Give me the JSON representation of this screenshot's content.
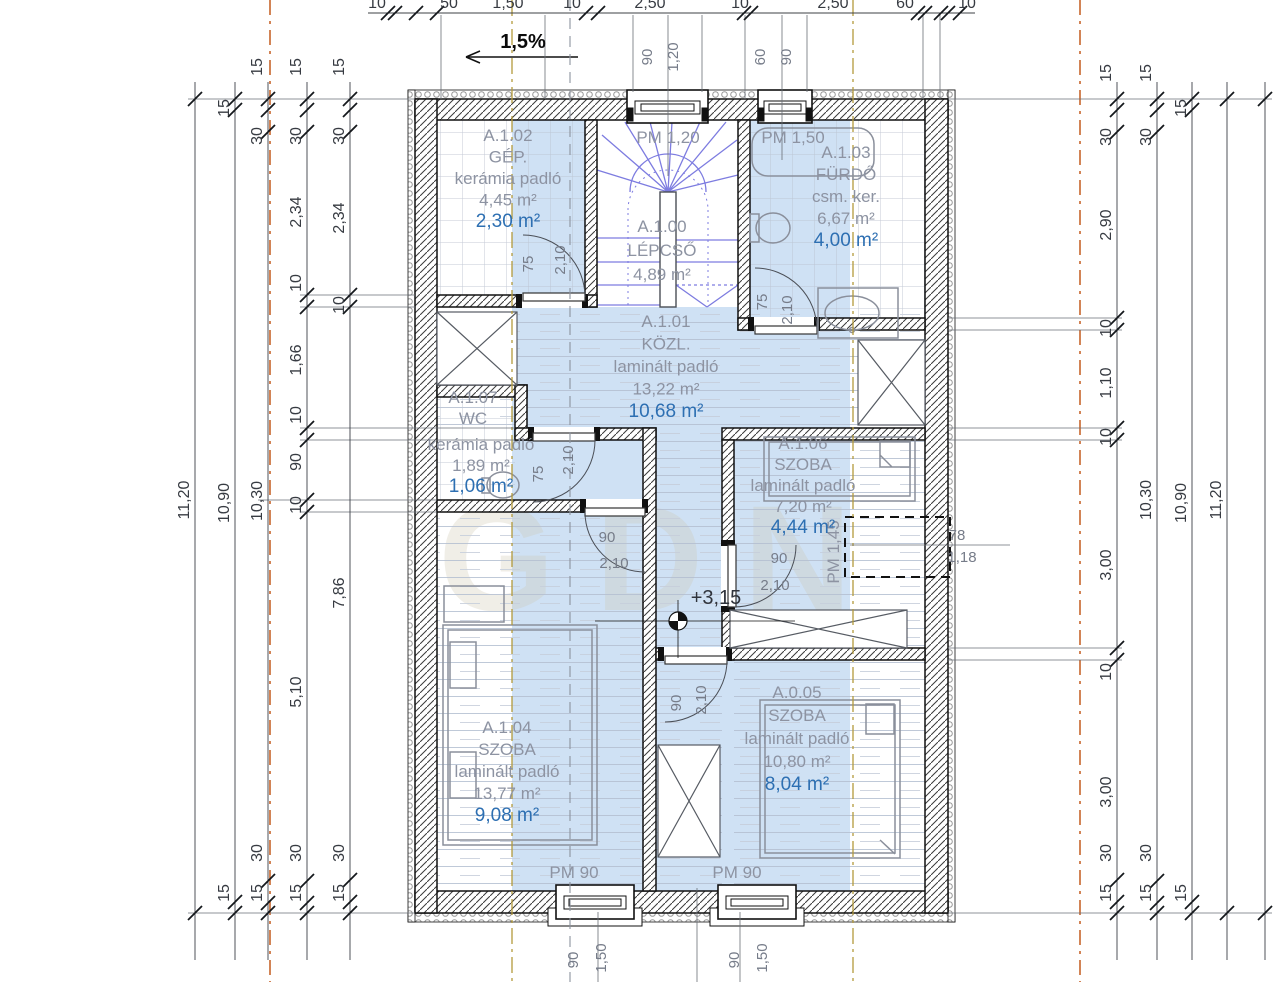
{
  "plan": {
    "watermark": "GDN",
    "rooms": [
      {
        "x": 508,
        "y": 141,
        "lh": 21.5,
        "lines": [
          [
            "A.1.02",
            "g"
          ],
          [
            "GÉP.",
            "g"
          ],
          [
            "kerámia padló",
            "g"
          ],
          [
            "4,45 m²",
            "g"
          ],
          [
            "2,30 m²",
            "b"
          ]
        ]
      },
      {
        "x": 662,
        "y": 232,
        "lh": 24,
        "lines": [
          [
            "A.1.00",
            "g"
          ],
          [
            "LÉPCSŐ",
            "g"
          ],
          [
            "4,89 m²",
            "g"
          ]
        ]
      },
      {
        "x": 846,
        "y": 158,
        "lh": 22,
        "lines": [
          [
            "A.1.03",
            "g"
          ],
          [
            "FÜRDŐ",
            "g"
          ],
          [
            "csm. ker.",
            "g"
          ],
          [
            "6,67 m²",
            "g"
          ],
          [
            "4,00 m²",
            "b"
          ]
        ]
      },
      {
        "x": 666,
        "y": 327,
        "lh": 22.5,
        "lines": [
          [
            "A.1.01",
            "g"
          ],
          [
            "KÖZL.",
            "g"
          ],
          [
            "laminált padló",
            "g"
          ],
          [
            "13,22 m²",
            "g"
          ],
          [
            "10,68 m²",
            "b"
          ]
        ]
      },
      {
        "x": 473,
        "y": 403,
        "lh": 21,
        "lines": [
          [
            "A.1.07",
            "g"
          ],
          [
            "WC",
            "g"
          ]
        ]
      },
      {
        "x": 481,
        "y": 450,
        "lh": 21,
        "lines": [
          [
            "kerámia padló",
            "g"
          ],
          [
            "1,89 m²",
            "g"
          ],
          [
            "1,06 m²",
            "b"
          ]
        ]
      },
      {
        "x": 803,
        "y": 449,
        "lh": 21,
        "lines": [
          [
            "A.1.06",
            "g"
          ],
          [
            "SZOBA",
            "g"
          ],
          [
            "laminált padló",
            "g"
          ],
          [
            "7,20 m²",
            "g"
          ],
          [
            "4,44 m²",
            "b"
          ]
        ]
      },
      {
        "x": 507,
        "y": 733,
        "lh": 22,
        "lines": [
          [
            "A.1.04",
            "g"
          ],
          [
            "SZOBA",
            "g"
          ],
          [
            "laminált padló",
            "g"
          ],
          [
            "13,77 m²",
            "g"
          ],
          [
            "9,08 m²",
            "b"
          ]
        ]
      },
      {
        "x": 797,
        "y": 698,
        "lh": 23,
        "lines": [
          [
            "A.0.05",
            "g"
          ],
          [
            "SZOBA",
            "g"
          ],
          [
            "laminált padló",
            "g"
          ],
          [
            "10,80 m²",
            "g"
          ],
          [
            "8,04 m²",
            "b"
          ]
        ]
      }
    ],
    "annotations": [
      {
        "t": "1,5%",
        "x": 523,
        "y": 48,
        "cls": "ann-slope"
      },
      {
        "t": "90",
        "x": 652,
        "y": 57,
        "rot": 1,
        "cls": "ann-dim"
      },
      {
        "t": "1,20",
        "x": 678,
        "y": 57,
        "rot": 1,
        "cls": "ann-dim"
      },
      {
        "t": "60",
        "x": 765,
        "y": 57,
        "rot": 1,
        "cls": "ann-dim"
      },
      {
        "t": "90",
        "x": 791,
        "y": 57,
        "rot": 1,
        "cls": "ann-dim"
      },
      {
        "t": "PM 1,20",
        "x": 668,
        "y": 143,
        "cls": "ann-pm"
      },
      {
        "t": "PM 1,50",
        "x": 793,
        "y": 143,
        "cls": "ann-pm"
      },
      {
        "t": "75",
        "x": 533,
        "y": 264,
        "rot": 1,
        "cls": "ann-dim"
      },
      {
        "t": "2,10",
        "x": 565,
        "y": 260,
        "rot": 1,
        "cls": "ann-dim"
      },
      {
        "t": "75",
        "x": 767,
        "y": 302,
        "rot": 1,
        "cls": "ann-dim"
      },
      {
        "t": "2,10",
        "x": 792,
        "y": 310,
        "rot": 1,
        "cls": "ann-dim"
      },
      {
        "t": "75",
        "x": 543,
        "y": 474,
        "rot": 1,
        "cls": "ann-dim"
      },
      {
        "t": "2,10",
        "x": 573,
        "y": 460,
        "rot": 1,
        "cls": "ann-dim"
      },
      {
        "t": "90",
        "x": 607,
        "y": 542,
        "cls": "ann-dim"
      },
      {
        "t": "2,10",
        "x": 614,
        "y": 568,
        "cls": "ann-dim"
      },
      {
        "t": "90",
        "x": 779,
        "y": 563,
        "cls": "ann-dim"
      },
      {
        "t": "2,10",
        "x": 775,
        "y": 590,
        "cls": "ann-dim"
      },
      {
        "t": "90",
        "x": 681,
        "y": 703,
        "rot": 1,
        "cls": "ann-dim"
      },
      {
        "t": "2,10",
        "x": 706,
        "y": 700,
        "rot": 1,
        "cls": "ann-dim"
      },
      {
        "t": "+3,15",
        "x": 716,
        "y": 604,
        "cls": "ann-level"
      },
      {
        "t": "PM 1,45",
        "x": 839,
        "y": 552,
        "rot": 1,
        "cls": "ann-pm"
      },
      {
        "t": "78",
        "x": 957,
        "y": 540,
        "cls": "ann-dim"
      },
      {
        "t": "1,18",
        "x": 962,
        "y": 562,
        "cls": "ann-dim"
      },
      {
        "t": "PM 90",
        "x": 574,
        "y": 878,
        "cls": "ann-pm"
      },
      {
        "t": "PM 90",
        "x": 737,
        "y": 878,
        "cls": "ann-pm"
      },
      {
        "t": "90",
        "x": 578,
        "y": 960,
        "rot": 1,
        "cls": "ann-dim"
      },
      {
        "t": "1,50",
        "x": 606,
        "y": 958,
        "rot": 1,
        "cls": "ann-dim"
      },
      {
        "t": "90",
        "x": 739,
        "y": 960,
        "rot": 1,
        "cls": "ann-dim"
      },
      {
        "t": "1,50",
        "x": 767,
        "y": 958,
        "rot": 1,
        "cls": "ann-dim"
      }
    ]
  },
  "dims": {
    "vchains": [
      {
        "x": 195,
        "y1": 82,
        "y2": 960,
        "ticks": [
          99,
          913
        ],
        "labels": [
          {
            "t": "11,20",
            "y": 500
          }
        ]
      },
      {
        "x": 235,
        "y1": 82,
        "y2": 960,
        "ticks": [
          99,
          110,
          902,
          913
        ],
        "labels": [
          {
            "t": "15",
            "y": 108
          },
          {
            "t": "10,90",
            "y": 503
          },
          {
            "t": "15",
            "y": 893
          }
        ]
      },
      {
        "x": 268,
        "y1": 82,
        "y2": 960,
        "ticks": [
          99,
          110,
          132,
          881,
          903,
          913
        ],
        "labels": [
          {
            "t": "15",
            "y": 67
          },
          {
            "t": "30",
            "y": 136
          },
          {
            "t": "10,30",
            "y": 501
          },
          {
            "t": "30",
            "y": 853
          },
          {
            "t": "15",
            "y": 893
          }
        ]
      },
      {
        "x": 307,
        "y1": 82,
        "y2": 960,
        "ticks": [
          99,
          110,
          132,
          295,
          307,
          428,
          440,
          500,
          512,
          881,
          903,
          913
        ],
        "labels": [
          {
            "t": "15",
            "y": 67
          },
          {
            "t": "30",
            "y": 136
          },
          {
            "t": "2,34",
            "y": 212
          },
          {
            "t": "10",
            "y": 283
          },
          {
            "t": "1,66",
            "y": 360
          },
          {
            "t": "10",
            "y": 415
          },
          {
            "t": "90",
            "y": 462
          },
          {
            "t": "10",
            "y": 505
          },
          {
            "t": "5,10",
            "y": 692
          },
          {
            "t": "30",
            "y": 853
          },
          {
            "t": "15",
            "y": 893
          }
        ]
      },
      {
        "x": 350,
        "y1": 82,
        "y2": 960,
        "ticks": [
          99,
          110,
          132,
          295,
          307,
          880,
          902,
          913
        ],
        "labels": [
          {
            "t": "15",
            "y": 67
          },
          {
            "t": "30",
            "y": 136
          },
          {
            "t": "2,34",
            "y": 218
          },
          {
            "t": "10",
            "y": 305
          },
          {
            "t": "7,86",
            "y": 593
          },
          {
            "t": "30",
            "y": 853
          },
          {
            "t": "15",
            "y": 893
          }
        ]
      },
      {
        "x": 1117,
        "y1": 82,
        "y2": 960,
        "ticks": [
          99,
          110,
          132,
          318,
          330,
          428,
          440,
          648,
          660,
          880,
          902,
          913
        ],
        "labels": [
          {
            "t": "15",
            "y": 73
          },
          {
            "t": "30",
            "y": 137
          },
          {
            "t": "2,90",
            "y": 225
          },
          {
            "t": "10",
            "y": 328
          },
          {
            "t": "1,10",
            "y": 383
          },
          {
            "t": "10",
            "y": 437
          },
          {
            "t": "3,00",
            "y": 565
          },
          {
            "t": "10",
            "y": 672
          },
          {
            "t": "3,00",
            "y": 792
          },
          {
            "t": "30",
            "y": 853
          },
          {
            "t": "15",
            "y": 893
          }
        ]
      },
      {
        "x": 1157,
        "y1": 82,
        "y2": 960,
        "ticks": [
          99,
          110,
          132,
          881,
          903,
          913
        ],
        "labels": [
          {
            "t": "15",
            "y": 73
          },
          {
            "t": "30",
            "y": 137
          },
          {
            "t": "10,30",
            "y": 500
          },
          {
            "t": "30",
            "y": 853
          },
          {
            "t": "15",
            "y": 893
          }
        ]
      },
      {
        "x": 1192,
        "y1": 82,
        "y2": 960,
        "ticks": [
          99,
          110,
          902,
          913
        ],
        "labels": [
          {
            "t": "15",
            "y": 108
          },
          {
            "t": "10,90",
            "y": 503
          },
          {
            "t": "15",
            "y": 893
          }
        ]
      },
      {
        "x": 1227,
        "y1": 82,
        "y2": 960,
        "ticks": [
          99,
          913
        ],
        "labels": [
          {
            "t": "11,20",
            "y": 500
          }
        ]
      },
      {
        "x": 1265,
        "y1": 82,
        "y2": 960,
        "ticks": [
          99,
          913
        ],
        "labels": []
      }
    ],
    "hchain": {
      "y": 13,
      "x1": 368,
      "x2": 975,
      "ticks": [
        388,
        395,
        416,
        437,
        586,
        598,
        744,
        751,
        918,
        925,
        941,
        948,
        960
      ],
      "labels": [
        {
          "t": "10",
          "x": 377
        },
        {
          "t": "50",
          "x": 449
        },
        {
          "t": "1,50",
          "x": 508
        },
        {
          "t": "10",
          "x": 572
        },
        {
          "t": "2,50",
          "x": 650
        },
        {
          "t": "10",
          "x": 740
        },
        {
          "t": "2,50",
          "x": 833
        },
        {
          "t": "60",
          "x": 905
        },
        {
          "t": "10",
          "x": 967
        }
      ]
    }
  },
  "lines": [
    {
      "x1": 270,
      "y1": 0,
      "x2": 270,
      "y2": 982,
      "cls": "ln-orange"
    },
    {
      "x1": 1080,
      "y1": 0,
      "x2": 1080,
      "y2": 982,
      "cls": "ln-orange"
    },
    {
      "x1": 512,
      "y1": 0,
      "x2": 512,
      "y2": 982,
      "cls": "ln-tan"
    },
    {
      "x1": 853,
      "y1": 0,
      "x2": 853,
      "y2": 982,
      "cls": "ln-tan"
    },
    {
      "x1": 570,
      "y1": 0,
      "x2": 570,
      "y2": 982,
      "cls": "ln-sect"
    },
    {
      "x1": 441,
      "y1": 15,
      "x2": 441,
      "y2": 99,
      "cls": "ln-ext"
    },
    {
      "x1": 545,
      "y1": 15,
      "x2": 545,
      "y2": 99,
      "cls": "ln-ext"
    },
    {
      "x1": 633,
      "y1": 15,
      "x2": 633,
      "y2": 92,
      "cls": "ln-ext"
    },
    {
      "x1": 668,
      "y1": 15,
      "x2": 668,
      "y2": 176,
      "cls": "ln-ext"
    },
    {
      "x1": 702,
      "y1": 15,
      "x2": 702,
      "y2": 92,
      "cls": "ln-ext"
    },
    {
      "x1": 745,
      "y1": 15,
      "x2": 745,
      "y2": 99,
      "cls": "ln-ext"
    },
    {
      "x1": 782,
      "y1": 15,
      "x2": 782,
      "y2": 160,
      "cls": "ln-ext"
    },
    {
      "x1": 807,
      "y1": 15,
      "x2": 807,
      "y2": 92,
      "cls": "ln-ext"
    },
    {
      "x1": 923,
      "y1": 15,
      "x2": 923,
      "y2": 99,
      "cls": "ln-ext"
    },
    {
      "x1": 940,
      "y1": 15,
      "x2": 940,
      "y2": 99,
      "cls": "ln-ext"
    },
    {
      "x1": 598,
      "y1": 912,
      "x2": 598,
      "y2": 982,
      "cls": "ln-ext"
    },
    {
      "x1": 697,
      "y1": 888,
      "x2": 697,
      "y2": 982,
      "cls": "ln-ext"
    },
    {
      "x1": 740,
      "y1": 912,
      "x2": 740,
      "y2": 982,
      "cls": "ln-ext"
    },
    {
      "x1": 188,
      "y1": 99,
      "x2": 415,
      "y2": 99,
      "cls": "ln-ext"
    },
    {
      "x1": 188,
      "y1": 913,
      "x2": 415,
      "y2": 913,
      "cls": "ln-ext"
    },
    {
      "x1": 300,
      "y1": 295,
      "x2": 415,
      "y2": 295,
      "cls": "ln-ext"
    },
    {
      "x1": 300,
      "y1": 307,
      "x2": 415,
      "y2": 307,
      "cls": "ln-ext"
    },
    {
      "x1": 300,
      "y1": 428,
      "x2": 515,
      "y2": 428,
      "cls": "ln-ext"
    },
    {
      "x1": 300,
      "y1": 440,
      "x2": 515,
      "y2": 440,
      "cls": "ln-ext"
    },
    {
      "x1": 258,
      "y1": 500,
      "x2": 437,
      "y2": 500,
      "cls": "ln-ext"
    },
    {
      "x1": 300,
      "y1": 512,
      "x2": 437,
      "y2": 512,
      "cls": "ln-ext"
    },
    {
      "x1": 948,
      "y1": 99,
      "x2": 1272,
      "y2": 99,
      "cls": "ln-ext"
    },
    {
      "x1": 948,
      "y1": 913,
      "x2": 1272,
      "y2": 913,
      "cls": "ln-ext"
    },
    {
      "x1": 948,
      "y1": 318,
      "x2": 1122,
      "y2": 318,
      "cls": "ln-ext"
    },
    {
      "x1": 948,
      "y1": 330,
      "x2": 1122,
      "y2": 330,
      "cls": "ln-ext"
    },
    {
      "x1": 948,
      "y1": 428,
      "x2": 1122,
      "y2": 428,
      "cls": "ln-ext"
    },
    {
      "x1": 948,
      "y1": 440,
      "x2": 1122,
      "y2": 440,
      "cls": "ln-ext"
    },
    {
      "x1": 948,
      "y1": 648,
      "x2": 1122,
      "y2": 648,
      "cls": "ln-ext"
    },
    {
      "x1": 948,
      "y1": 660,
      "x2": 1122,
      "y2": 660,
      "cls": "ln-ext"
    },
    {
      "x1": 850,
      "y1": 545,
      "x2": 1010,
      "y2": 545,
      "cls": "ln-ext"
    }
  ]
}
